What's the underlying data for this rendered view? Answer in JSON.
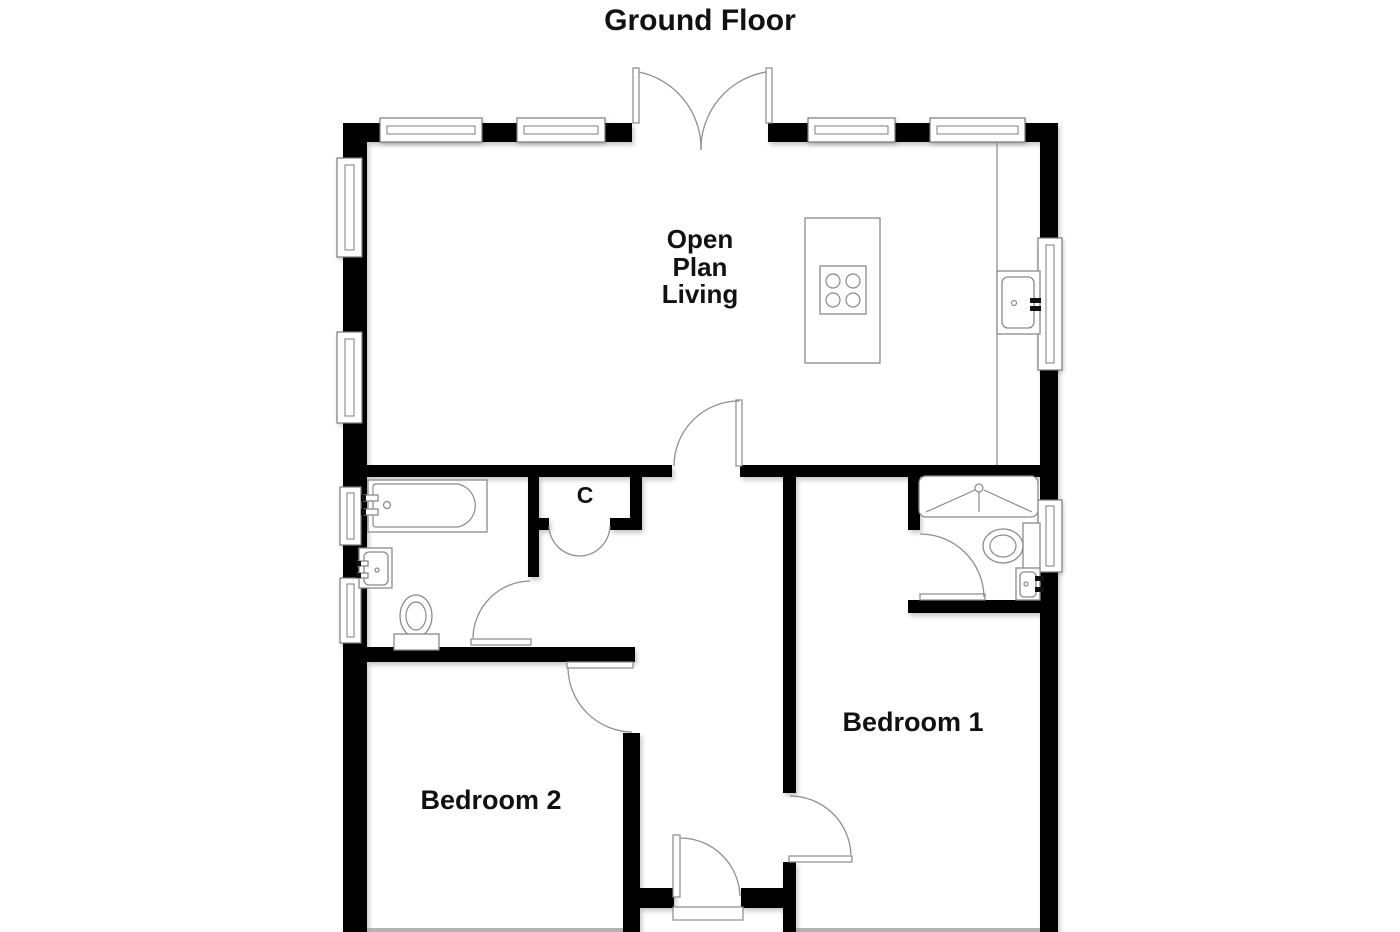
{
  "title": "Ground Floor",
  "rooms": {
    "living": {
      "name": "Open Plan Living",
      "lines": [
        "Open",
        "Plan",
        "Living"
      ]
    },
    "bedroom1": {
      "name": "Bedroom 1"
    },
    "bedroom2": {
      "name": "Bedroom 2"
    },
    "cupboard": {
      "name": "C"
    }
  },
  "fixtures": {
    "kitchen": [
      "island-hob",
      "sink"
    ],
    "bathroom": [
      "bath",
      "washbasin",
      "toilet"
    ],
    "ensuite": [
      "shower",
      "toilet",
      "washbasin"
    ]
  },
  "doors": [
    "french-doors",
    "living-room-door",
    "cupboard-double-doors",
    "bathroom-door",
    "bedroom2-door",
    "bedroom1-door",
    "ensuite-door",
    "front-door"
  ],
  "colors": {
    "wall": "#000000",
    "floor": "#ffffff",
    "fixture_outline": "#8a8a8a",
    "door_arc": "#909090",
    "text": "#111111",
    "background": "#ffffff"
  }
}
